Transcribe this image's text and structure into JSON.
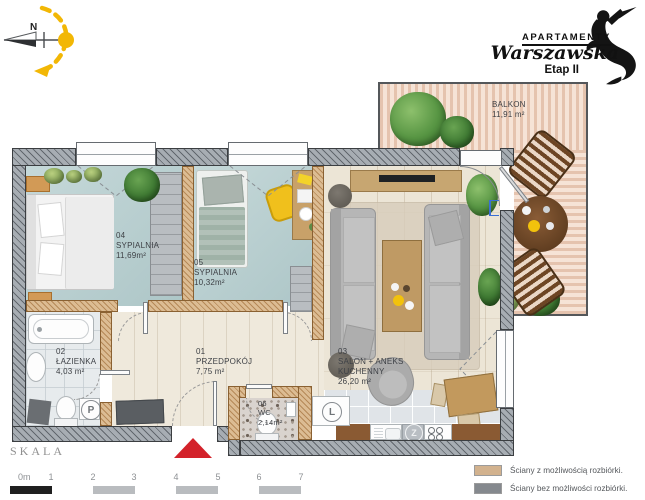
{
  "logo": {
    "brand_top": "APARTAMENTY",
    "brand_main": "Warszawska",
    "brand_sub": "Etap II"
  },
  "compass": {
    "north": "N"
  },
  "plan": {
    "rooms": {
      "hall": {
        "num": "01",
        "name": "PRZEDPOKÓJ",
        "area": "7,75 m²"
      },
      "bath": {
        "num": "02",
        "name": "ŁAZIENKA",
        "area": "4,03 m²"
      },
      "salon": {
        "num": "03",
        "name": "SALON + ANEKS KUCHENNY",
        "area": "26,20 m²"
      },
      "bed1": {
        "num": "04",
        "name": "SYPIALNIA",
        "area": "11,69m²"
      },
      "bed2": {
        "num": "05",
        "name": "SYPIALNIA",
        "area": "10,32m²"
      },
      "wc": {
        "num": "06",
        "name": "WC",
        "area": "2,14m²"
      },
      "balcony": {
        "name": "BALKON",
        "area": "11,91 m²"
      }
    },
    "symbols": {
      "washing_machine": "P",
      "fridge": "L",
      "dishwasher": "Z"
    }
  },
  "scale": {
    "label": "SKALA",
    "ticks": [
      "0m",
      "1",
      "2",
      "3",
      "4",
      "5",
      "6",
      "7"
    ]
  },
  "legend": {
    "demolishable": {
      "label": "Ściany z możliwością rozbiórki.",
      "swatch": "#d2b28e"
    },
    "structural": {
      "label": "Ściany bez możliwości rozbiórki.",
      "swatch": "#85898e"
    }
  },
  "colors": {
    "accent_yellow": "#f2b705",
    "entrance_red": "#d3222a",
    "wall_structural": "#a7adb3",
    "wall_demolishable": "#dcbc93",
    "bedroom_floor": "#b9d0d1",
    "deck": "#f6e3d6"
  }
}
